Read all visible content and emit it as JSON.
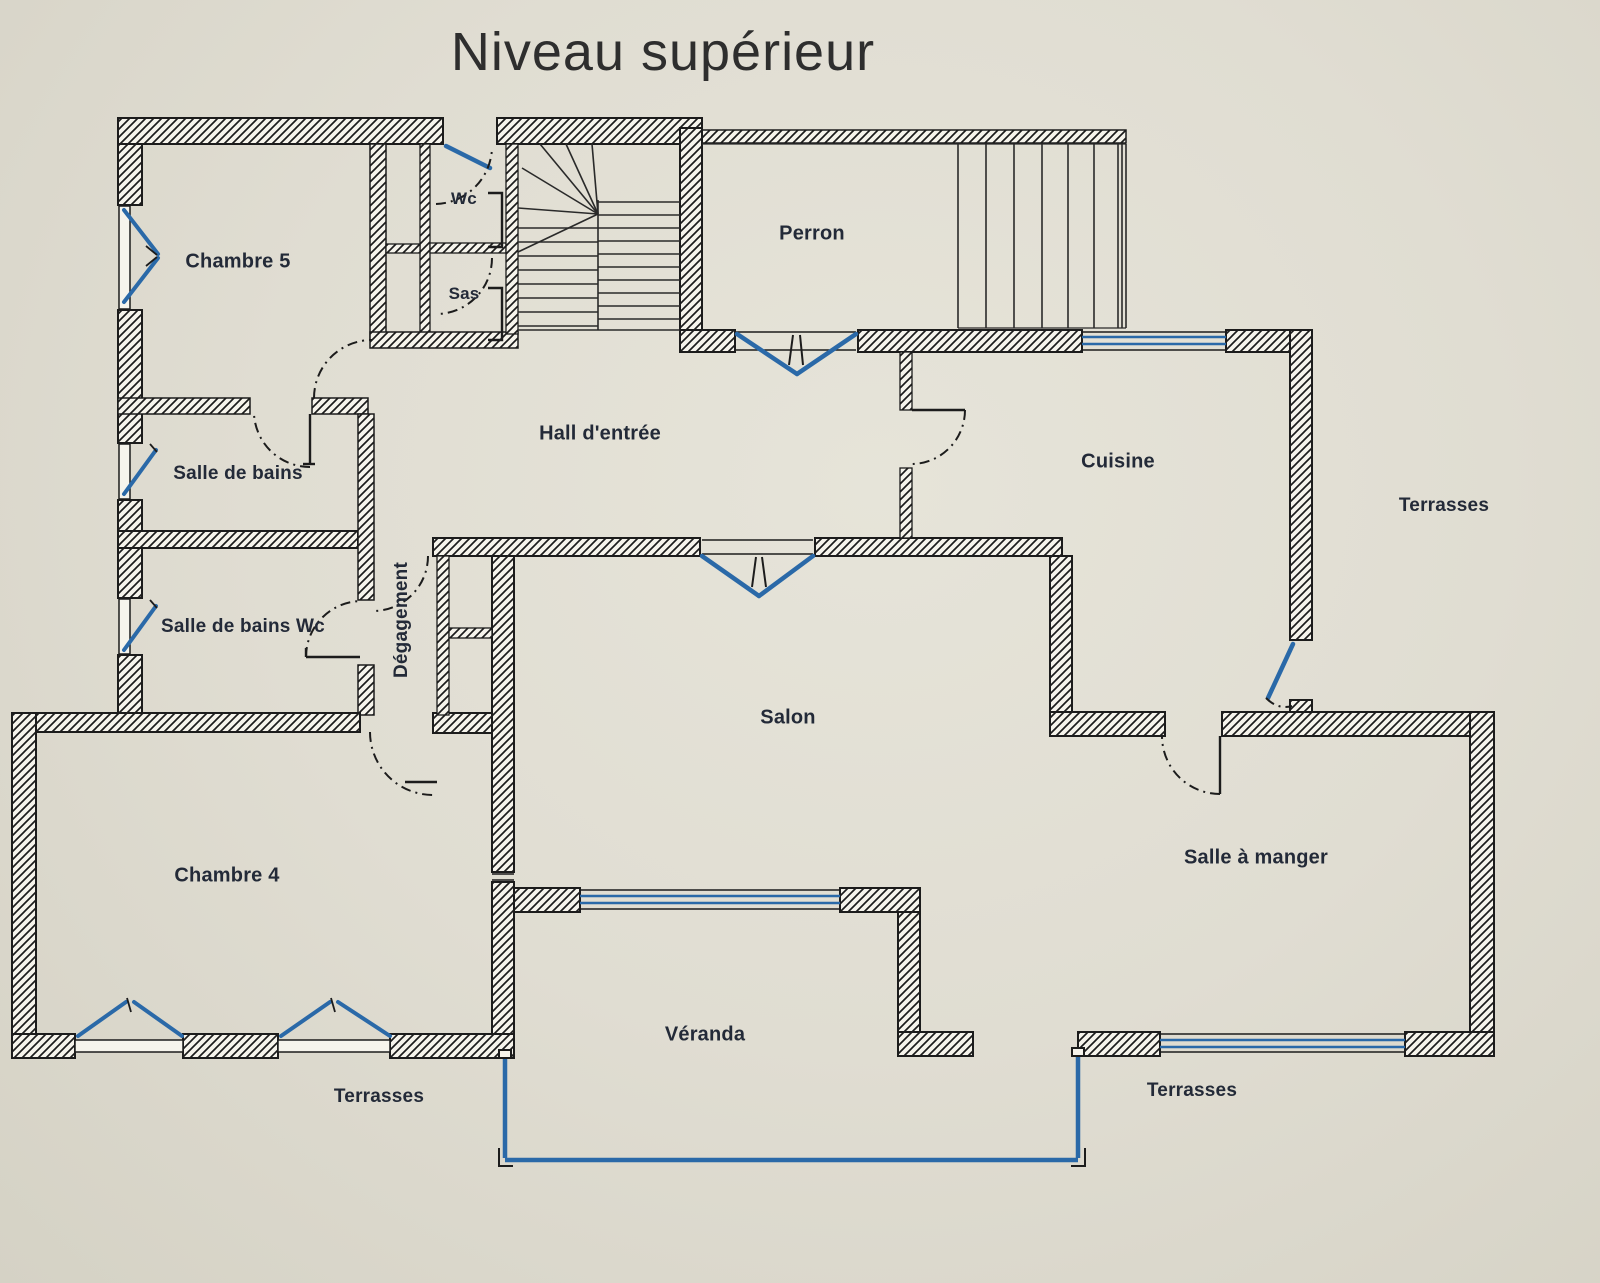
{
  "title": "Niveau supérieur",
  "rooms": {
    "chambre5": "Chambre 5",
    "wc": "Wc",
    "sas": "Sas",
    "perron": "Perron",
    "hall": "Hall d'entrée",
    "cuisine": "Cuisine",
    "salle_de_bains": "Salle de bains",
    "salle_de_bains_wc": "Salle de bains Wc",
    "degagement": "Dégagement",
    "salon": "Salon",
    "chambre4": "Chambre 4",
    "salle_a_manger": "Salle à manger",
    "veranda": "Véranda",
    "terrasses_right": "Terrasses",
    "terrasses_bottom_left": "Terrasses",
    "terrasses_bottom_right": "Terrasses"
  },
  "colors": {
    "paper": "#e0ddd2",
    "wall_line": "#1c1c1c",
    "accent_blue": "#2a69a8",
    "label_text": "#232a38"
  }
}
